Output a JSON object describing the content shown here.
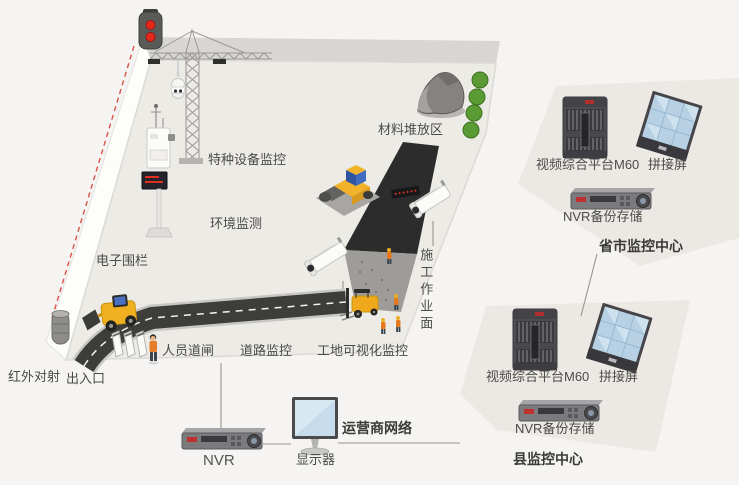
{
  "palette": {
    "background": "#f5f4f2",
    "site_floor": "#edebe6",
    "wall_band": "#d8d6d3",
    "center_plot": "#ece9e4",
    "road_dark": "#3d3d3b",
    "fence_red": "#d9534a",
    "machine_yellow": "#f2b32a",
    "screen_blue": "#b7d0e4",
    "tree_green": "#5b9b33",
    "label_text": "#4b4b49"
  },
  "site": {
    "labels": {
      "special_equipment": "特种设备监控",
      "environment": "环境监测",
      "material_area": "材料堆放区",
      "electronic_fence": "电子围栏",
      "infrared": "红外对射",
      "entrance": "出入口",
      "personnel_gate": "人员道闸",
      "road_monitoring": "道路监控",
      "site_visual_monitoring": "工地可视化监控",
      "work_surface": "施工作业面"
    }
  },
  "ground": {
    "nvr_label": "NVR",
    "monitor_label": "显示器",
    "network_label": "运营商网络"
  },
  "centers": {
    "province": {
      "platform": "视频综合平台M60",
      "video_wall": "拼接屏",
      "backup": "NVR备份存储",
      "title": "省市监控中心"
    },
    "county": {
      "platform": "视频综合平台M60",
      "video_wall": "拼接屏",
      "backup": "NVR备份存储",
      "title": "县监控中心"
    }
  }
}
